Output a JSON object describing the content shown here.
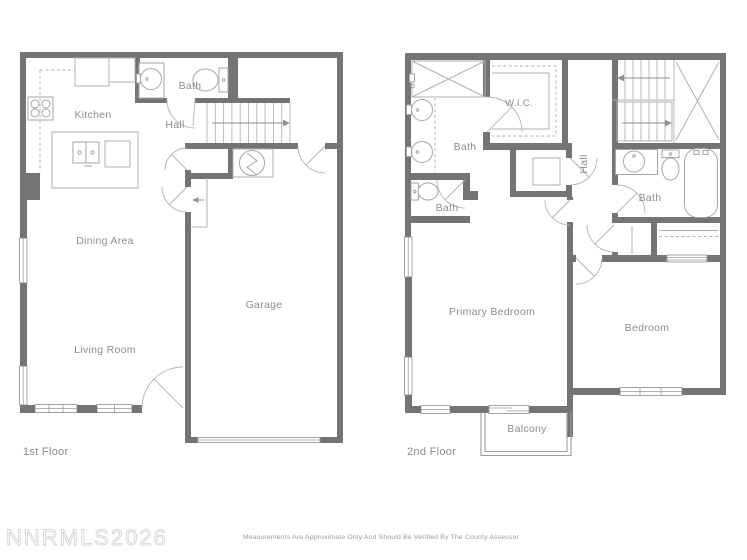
{
  "colors": {
    "bg": "#ffffff",
    "wall": "#747474",
    "line": "#b0b0b0",
    "fixture": "#a6a6a6",
    "label": "#8d8d8d",
    "watermark": "#c9c9c9",
    "disclaimer": "#9b9b9b"
  },
  "floor1": {
    "title": "1st Floor",
    "rooms": {
      "kitchen": "Kitchen",
      "bath": "Bath",
      "hall": "Hall",
      "dining": "Dining Area",
      "living": "Living Room",
      "garage": "Garage"
    }
  },
  "floor2": {
    "title": "2nd Floor",
    "rooms": {
      "wic": "W.I.C.",
      "bath_ensuite": "Bath",
      "bath_toilet": "Bath",
      "bath_hall": "Bath",
      "hall": "Hall",
      "primary_bedroom": "Primary Bedroom",
      "bedroom": "Bedroom",
      "balcony": "Balcony"
    }
  },
  "footer": {
    "watermark": "NNRMLS2026",
    "disclaimer": "Measurements Are Approximate Only And Should Be Verified By The County Assessor"
  }
}
